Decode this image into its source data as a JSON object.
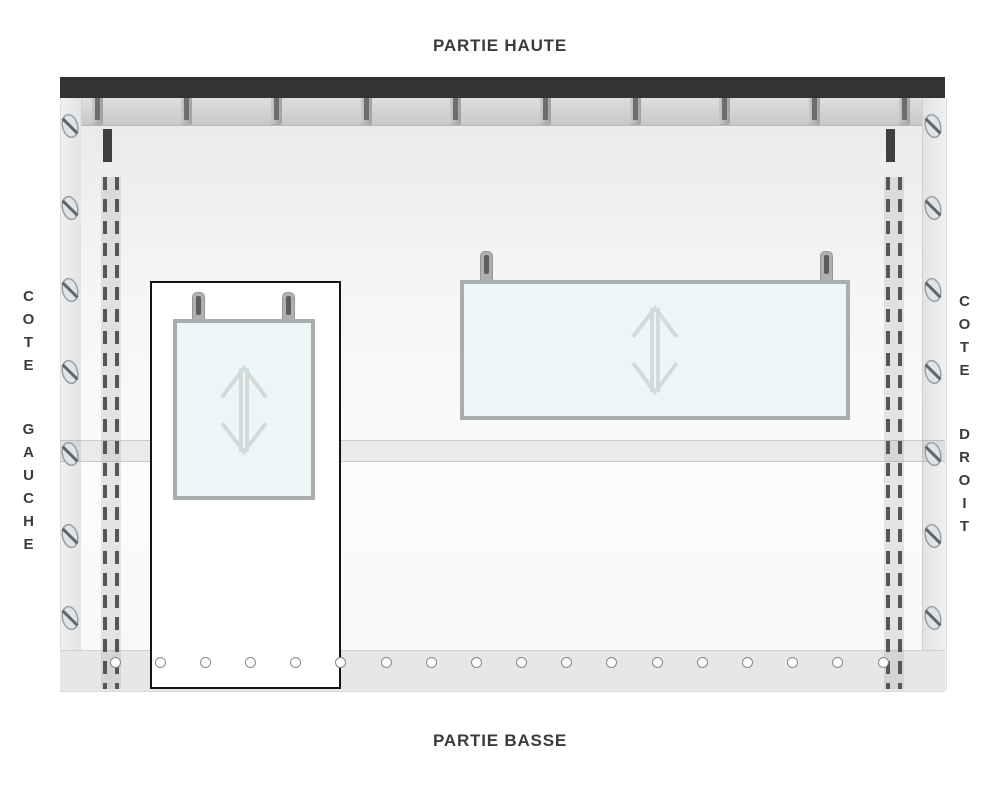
{
  "labels": {
    "top": "PARTIE HAUTE",
    "bottom": "PARTIE BASSE",
    "left": "COTE GAUCHE",
    "right": "COTE DROIT"
  },
  "colors": {
    "top_rail": "#333333",
    "label_text": "#3b3b3b",
    "frame_gray": "#e9e9e9",
    "window_fill": "#ebf7f7",
    "window_border": "#a8aeae",
    "dash_line": "#565656",
    "seam_tick": "#3f3f3f",
    "eyelet_ring": "#898989"
  },
  "structure": {
    "bracket_count": 10,
    "eyelet_count": 18,
    "screws_per_side": 7,
    "window_count": 2,
    "windows": [
      {
        "name": "window-left",
        "shape": "portrait",
        "arrow": "vertical-double-arrow"
      },
      {
        "name": "window-right",
        "shape": "landscape",
        "arrow": "vertical-double-arrow"
      }
    ]
  },
  "icons": {
    "bracket": "rail-bracket-icon",
    "screw": "screw-head-icon",
    "eyelet": "eyelet-hole-icon",
    "hanger": "hanger-tab-icon",
    "arrow": "vertical-double-arrow-icon"
  }
}
